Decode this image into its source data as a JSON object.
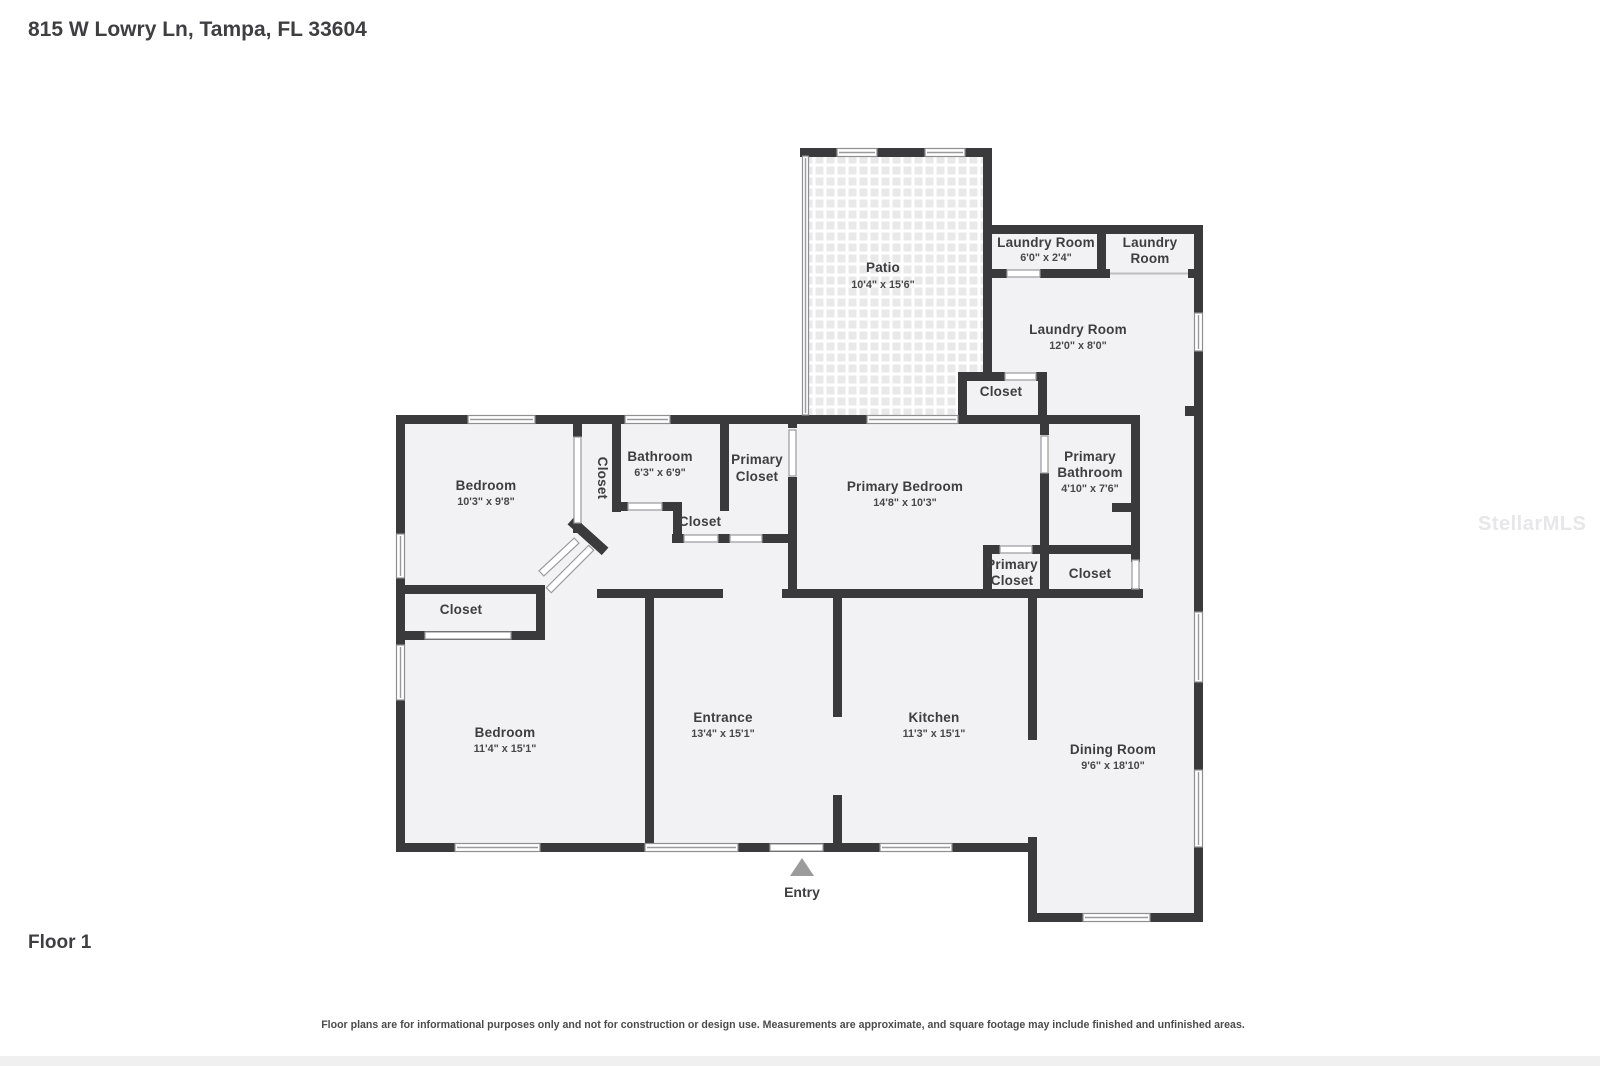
{
  "page": {
    "address": "815 W Lowry Ln, Tampa, FL 33604",
    "floor_label": "Floor 1",
    "disclaimer": "Floor plans are for informational purposes only and not for construction or design use. Measurements are approximate, and square footage may include finished and unfinished areas.",
    "watermark": "StellarMLS",
    "entry_label": "Entry"
  },
  "colors": {
    "wall": "#3a3a3c",
    "room_fill": "#f2f2f4",
    "label_text": "#3e3e40",
    "patio_tile": "#e9e9ea",
    "entry_arrow": "#9b9b9b",
    "watermark": "#e7e7e9"
  },
  "rooms": {
    "patio": {
      "name": "Patio",
      "size": "10'4\" x 15'6\""
    },
    "laundry_small": {
      "name": "Laundry Room",
      "size": "6'0\" x 2'4\""
    },
    "laundry_top_right": {
      "line1": "Laundry",
      "line2": "Room"
    },
    "laundry_main": {
      "name": "Laundry Room",
      "size": "12'0\" x 8'0\""
    },
    "laundry_closet": {
      "name": "Closet"
    },
    "bedroom_upper": {
      "name": "Bedroom",
      "size": "10'3\" x 9'8\""
    },
    "closet_vertical": {
      "name": "Closet"
    },
    "bathroom": {
      "name": "Bathroom",
      "size": "6'3\" x 6'9\""
    },
    "closet_hall": {
      "name": "Closet"
    },
    "primary_closet_upper": {
      "line1": "Primary",
      "line2": "Closet"
    },
    "primary_bedroom": {
      "name": "Primary Bedroom",
      "size": "14'8\" x 10'3\""
    },
    "primary_bathroom": {
      "line1": "Primary",
      "line2": "Bathroom",
      "size": "4'10\" x 7'6\""
    },
    "primary_closet_small": {
      "line1": "Primary",
      "line2": "Closet"
    },
    "closet_by_primary": {
      "name": "Closet"
    },
    "closet_bedroom2": {
      "name": "Closet"
    },
    "bedroom_lower": {
      "name": "Bedroom",
      "size": "11'4\" x 15'1\""
    },
    "entrance": {
      "name": "Entrance",
      "size": "13'4\" x 15'1\""
    },
    "kitchen": {
      "name": "Kitchen",
      "size": "11'3\" x 15'1\""
    },
    "dining": {
      "name": "Dining Room",
      "size": "9'6\" x 18'10\""
    }
  }
}
